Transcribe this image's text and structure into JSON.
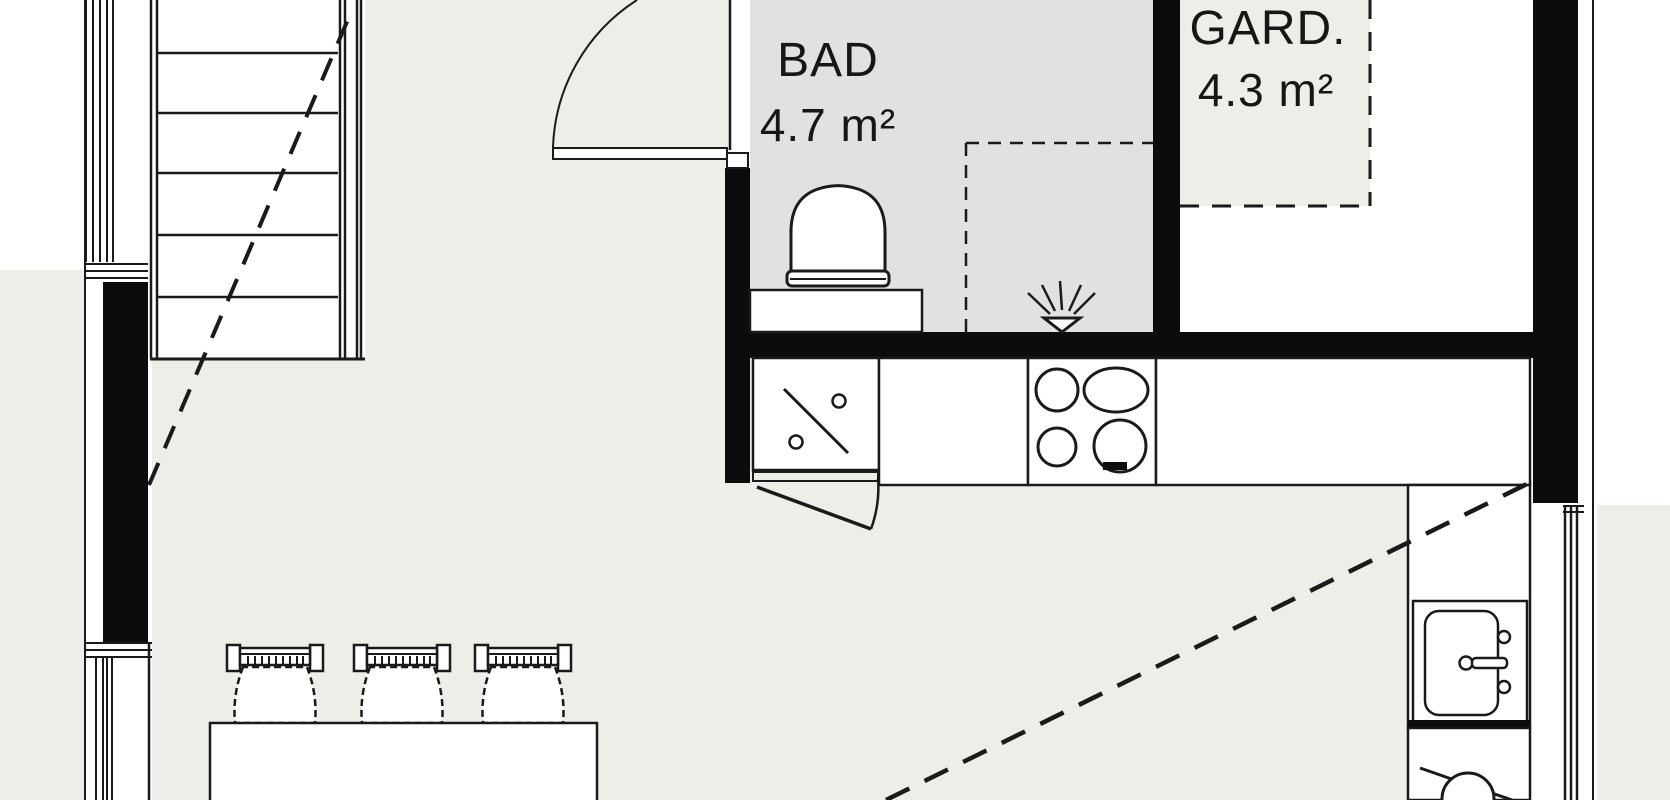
{
  "plan": {
    "type": "floor-plan",
    "rooms": [
      {
        "id": "bathroom",
        "label": "BAD",
        "area": "4.7 m²"
      },
      {
        "id": "wardrobe",
        "label": "GARD.",
        "area": "4.3 m²"
      }
    ],
    "fixtures": [
      "staircase",
      "stair-direction-dashed-line",
      "hinged-door-bathroom",
      "toilet",
      "vanity-counter",
      "shower-head",
      "shower-dashed-zone",
      "wardrobe-dashed-zone",
      "kitchen-counter",
      "sink-unit-symbol",
      "cooktop-4-burners",
      "kitchen-sink",
      "faucet",
      "dishwasher-symbol",
      "under-counter-door",
      "dining-table",
      "chairs",
      "windows",
      "sloped-ceiling-dashed-line"
    ]
  },
  "colors": {
    "paper_white": "#ffffff",
    "floor_beige": "#efede7",
    "bath_gray": "#e1e0e3",
    "wall_black": "#0c0c0c",
    "line_dark": "#1a1a1a"
  }
}
